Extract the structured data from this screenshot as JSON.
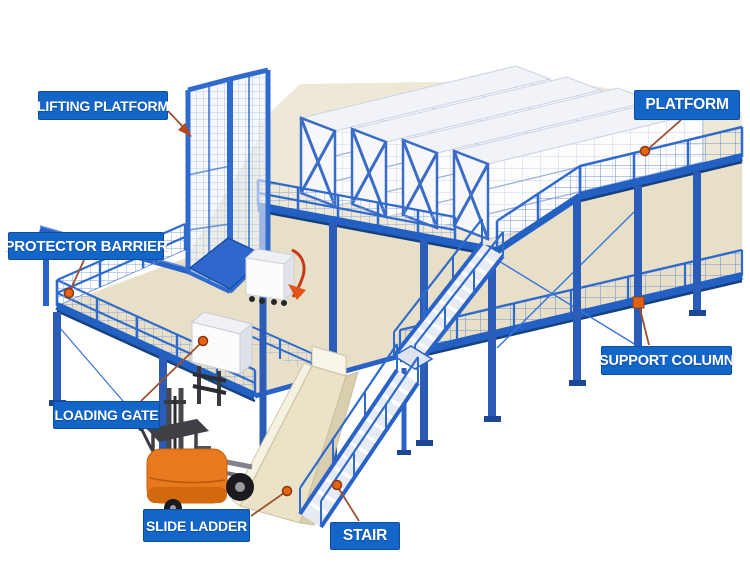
{
  "labels": {
    "lifting_platform": "LIFTING PLATFORM",
    "platform": "PLATFORM",
    "protector_barrier": "PROTECTOR BARRIER",
    "support_column": "SUPPORT COLUMN",
    "loading_gate": "LOADING GATE",
    "slide_ladder": "SLIDE LADDER",
    "stair": "STAIR"
  },
  "colors": {
    "label_bg": "#1365c8",
    "label_text": "#ffffff",
    "structure_blue": "#2f6bcd",
    "beam_blue": "#2360c4",
    "beam_dark_blue": "#16407e",
    "mesh_blue": "#7fa0da",
    "floor_beige": "#e9e2cd",
    "rack_white": "#fdfdfd",
    "rack_frame_blue": "#3a6cc8",
    "leader_line_brown": "#9c5130",
    "marker_orange": "#e8650f",
    "forklift_orange": "#e9791f",
    "slide_beige": "#ebe3c8",
    "background": "#ffffff"
  }
}
